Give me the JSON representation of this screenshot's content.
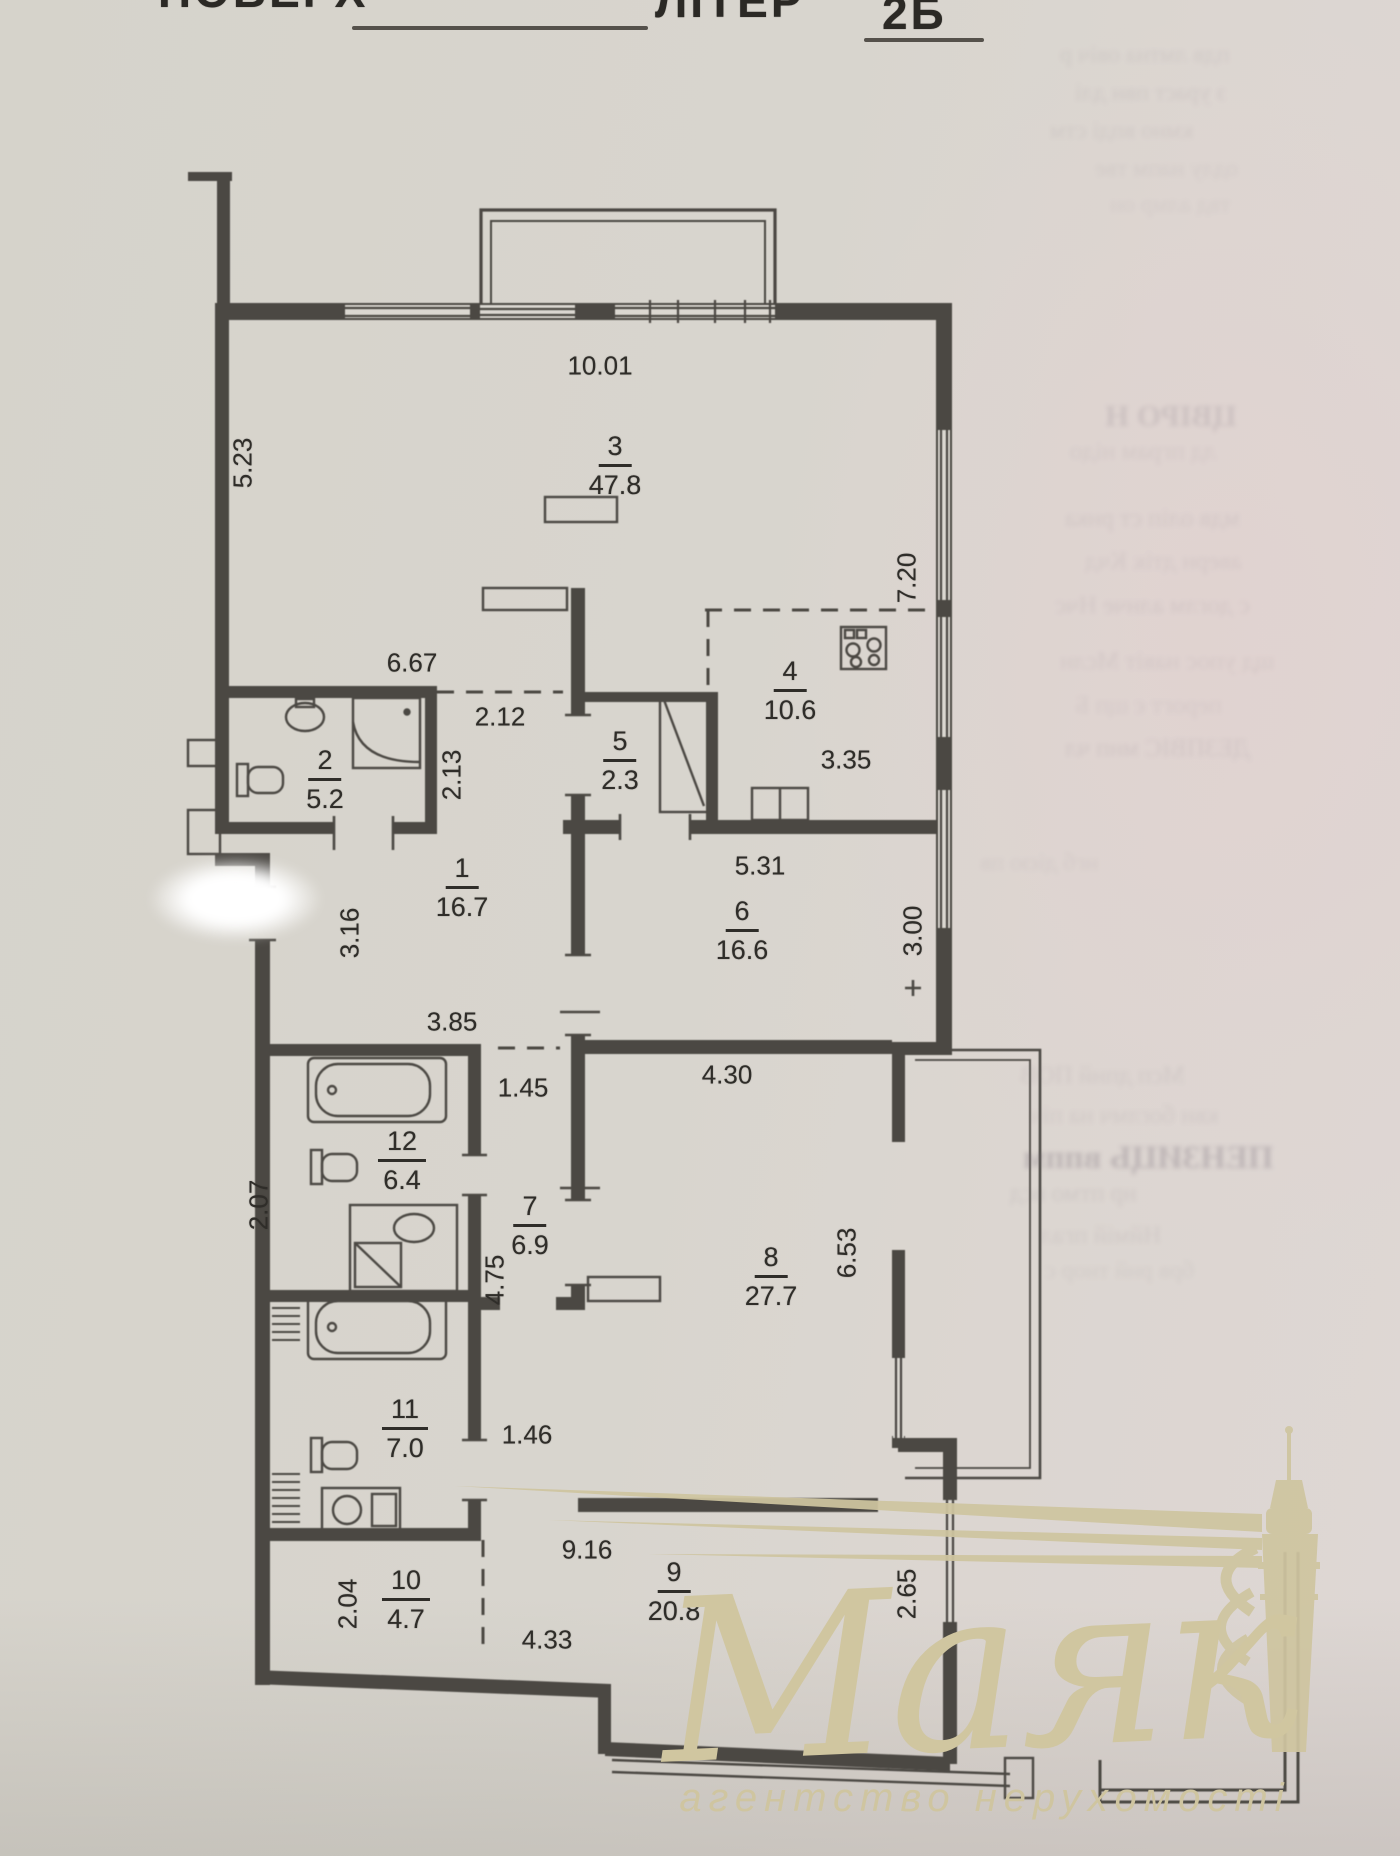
{
  "header": {
    "field_label": "ПОВЕРХ",
    "liter_label": "ЛІТЕР",
    "liter_value": "2Б"
  },
  "watermark": {
    "name": "Маяк",
    "subtitle": "агентство нерухомості",
    "color": "#d0c6a0"
  },
  "colors": {
    "ink": "#2f2d29",
    "walls": "#4b4843",
    "paper": "#d8d5ce",
    "paper_right_tint": "#ded7d4",
    "watermark": "#d0c6a0"
  },
  "plan": {
    "rooms": [
      {
        "number": "1",
        "area": "16.7",
        "x": 462,
        "y": 888
      },
      {
        "number": "2",
        "area": "5.2",
        "x": 325,
        "y": 780
      },
      {
        "number": "3",
        "area": "47.8",
        "x": 615,
        "y": 466
      },
      {
        "number": "4",
        "area": "10.6",
        "x": 790,
        "y": 691
      },
      {
        "number": "5",
        "area": "2.3",
        "x": 620,
        "y": 761
      },
      {
        "number": "6",
        "area": "16.6",
        "x": 742,
        "y": 931
      },
      {
        "number": "7",
        "area": "6.9",
        "x": 530,
        "y": 1226
      },
      {
        "number": "8",
        "area": "27.7",
        "x": 771,
        "y": 1277
      },
      {
        "number": "9",
        "area": "20.8",
        "x": 674,
        "y": 1592
      },
      {
        "number": "10",
        "area": "4.7",
        "x": 406,
        "y": 1600
      },
      {
        "number": "11",
        "area": "7.0",
        "x": 405,
        "y": 1429
      },
      {
        "number": "12",
        "area": "6.4",
        "x": 402,
        "y": 1161
      }
    ],
    "dimensions": [
      {
        "value": "10.01",
        "x": 600,
        "y": 366,
        "rot": 0
      },
      {
        "value": "5.23",
        "x": 243,
        "y": 463,
        "rot": -90
      },
      {
        "value": "7.20",
        "x": 907,
        "y": 578,
        "rot": -90
      },
      {
        "value": "6.67",
        "x": 412,
        "y": 663,
        "rot": 0
      },
      {
        "value": "2.12",
        "x": 500,
        "y": 717,
        "rot": 0
      },
      {
        "value": "2.13",
        "x": 452,
        "y": 775,
        "rot": -90
      },
      {
        "value": "3.35",
        "x": 846,
        "y": 760,
        "rot": 0
      },
      {
        "value": "5.31",
        "x": 760,
        "y": 866,
        "rot": 0
      },
      {
        "value": "3.16",
        "x": 350,
        "y": 933,
        "rot": -90
      },
      {
        "value": "3.00",
        "x": 913,
        "y": 931,
        "rot": -90
      },
      {
        "value": "3.85",
        "x": 452,
        "y": 1022,
        "rot": 0
      },
      {
        "value": "4.30",
        "x": 727,
        "y": 1075,
        "rot": 0
      },
      {
        "value": "1.45",
        "x": 523,
        "y": 1088,
        "rot": 0
      },
      {
        "value": "2.07",
        "x": 259,
        "y": 1205,
        "rot": -90
      },
      {
        "value": "4.75",
        "x": 495,
        "y": 1280,
        "rot": -90
      },
      {
        "value": "6.53",
        "x": 847,
        "y": 1253,
        "rot": -90
      },
      {
        "value": "1.46",
        "x": 527,
        "y": 1435,
        "rot": 0
      },
      {
        "value": "9.16",
        "x": 587,
        "y": 1550,
        "rot": 0
      },
      {
        "value": "2.04",
        "x": 348,
        "y": 1604,
        "rot": -90
      },
      {
        "value": "4.33",
        "x": 547,
        "y": 1640,
        "rot": 0
      },
      {
        "value": "2.65",
        "x": 907,
        "y": 1594,
        "rot": -90
      }
    ]
  },
  "bleed_through_lines": [
    {
      "text": "пдв лмтна овіч р",
      "x": 1200,
      "y": 42,
      "size": 24,
      "opacity": 0.1,
      "bold": false
    },
    {
      "text": "з ураст пвн длі",
      "x": 1215,
      "y": 80,
      "size": 24,
      "opacity": 0.11,
      "bold": false
    },
    {
      "text": "кмно впді стм",
      "x": 1190,
      "y": 118,
      "size": 24,
      "opacity": 0.1,
      "bold": false
    },
    {
      "text": "одлу напм тве",
      "x": 1235,
      "y": 156,
      "size": 24,
      "opacity": 0.09,
      "bold": false
    },
    {
      "text": "твд алмр он",
      "x": 1250,
      "y": 192,
      "size": 24,
      "opacity": 0.08,
      "bold": false
    },
    {
      "text": "ЦВІРО Н",
      "x": 1245,
      "y": 398,
      "size": 31,
      "opacity": 0.16,
      "bold": true
    },
    {
      "text": "лд пграм нідо",
      "x": 1210,
      "y": 438,
      "size": 25,
      "opacity": 0.1,
      "bold": false
    },
    {
      "text": "мдв оліп ст рнка",
      "x": 1205,
      "y": 505,
      "size": 25,
      "opacity": 0.11,
      "bold": false
    },
    {
      "text": "аверн дтік Кчд",
      "x": 1225,
      "y": 548,
      "size": 25,
      "opacity": 0.1,
      "bold": false
    },
    {
      "text": "с доглм алнче Нчс",
      "x": 1195,
      "y": 592,
      "size": 25,
      "opacity": 0.11,
      "bold": false
    },
    {
      "text": "щд упос навіт Мслн",
      "x": 1200,
      "y": 648,
      "size": 25,
      "opacity": 0.1,
      "bold": false
    },
    {
      "text": "перогт є щп Б",
      "x": 1215,
      "y": 692,
      "size": 25,
      "opacity": 0.09,
      "bold": false
    },
    {
      "text": "ДЕЗПВІС мнп чл",
      "x": 1205,
      "y": 735,
      "size": 25,
      "opacity": 0.12,
      "bold": false
    },
    {
      "text": "нгб дією пв",
      "x": 1120,
      "y": 850,
      "size": 24,
      "opacity": 0.09,
      "bold": false
    },
    {
      "text": "Мсп дпнй ПОВ",
      "x": 1160,
      "y": 1062,
      "size": 25,
      "opacity": 0.11,
      "bold": false
    },
    {
      "text": "квн боглмч на піч",
      "x": 1170,
      "y": 1102,
      "size": 25,
      "opacity": 0.1,
      "bold": false
    },
    {
      "text": "ПЕНЗИЦЬ вппм",
      "x": 1163,
      "y": 1140,
      "size": 33,
      "opacity": 0.28,
      "bold": true
    },
    {
      "text": "нр птмо всд",
      "x": 1150,
      "y": 1180,
      "size": 25,
      "opacity": 0.12,
      "bold": false
    },
    {
      "text": "Нймій пгал",
      "x": 1180,
      "y": 1222,
      "size": 25,
      "opacity": 0.11,
      "bold": false
    },
    {
      "text": "брв рнй тнор с",
      "x": 1185,
      "y": 1258,
      "size": 24,
      "opacity": 0.09,
      "bold": false
    }
  ]
}
